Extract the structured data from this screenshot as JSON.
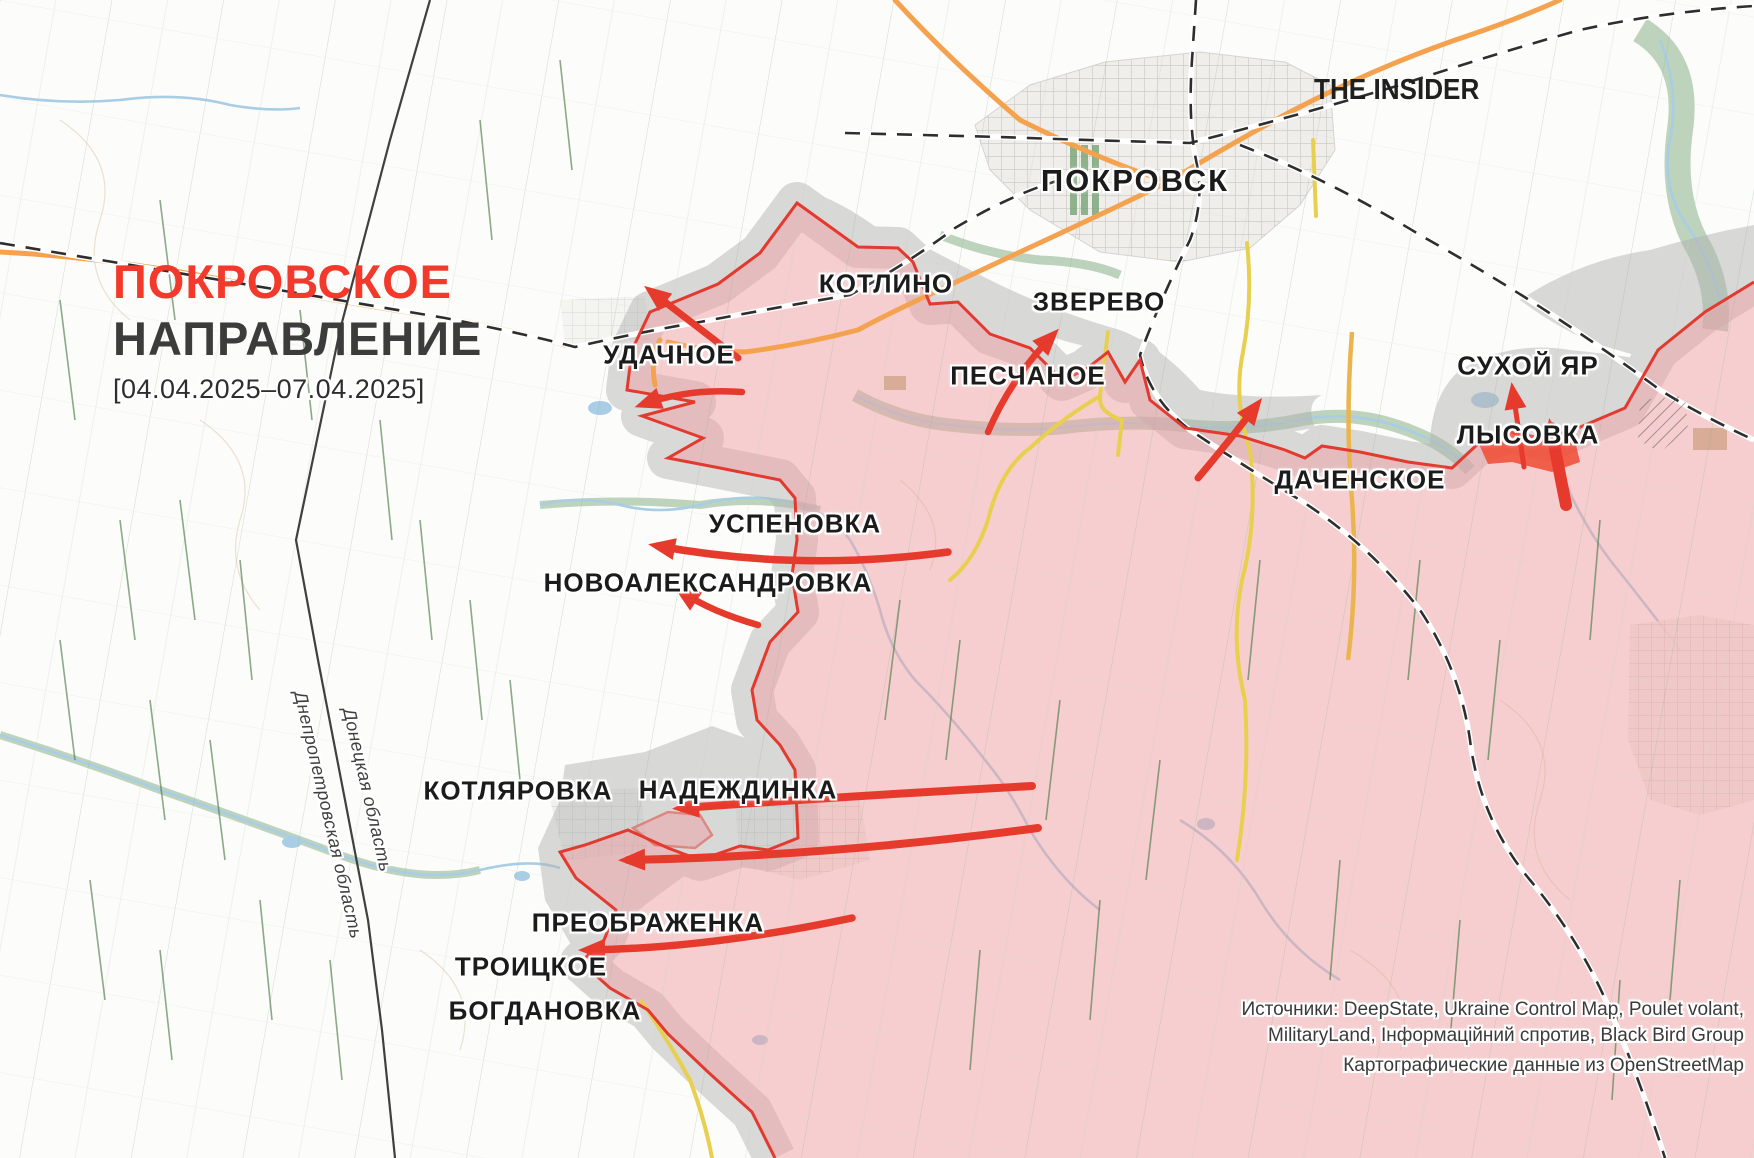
{
  "title": {
    "line1": "ПОКРОВСКОЕ",
    "line2": "НАПРАВЛЕНИЕ",
    "date_range": "[04.04.2025–07.04.2025]"
  },
  "branding": {
    "logo": "THE INSIDER"
  },
  "cities": {
    "pokrovsk": "ПОКРОВСК",
    "kotlino": "КОТЛИНО",
    "zverevo": "ЗВЕРЕВО",
    "udachnoe": "УДАЧНОЕ",
    "peschanoe": "ПЕСЧАНОЕ",
    "sukhoy_yar": "СУХОЙ ЯР",
    "lysovka": "ЛЫСОВКА",
    "dachenskoe": "ДАЧЕНСКОЕ",
    "uspenovka": "УСПЕНОВКА",
    "novoaleksandrovka": "НОВОАЛЕКСАНДРОВКА",
    "kotlyarovka": "КОТЛЯРОВКА",
    "nadezhdinka": "НАДЕЖДИНКА",
    "preobrazhenka": "ПРЕОБРАЖЕНКА",
    "troitskoe": "ТРОИЦКОЕ",
    "bogdanovka": "БОГДАНОВКА"
  },
  "regions": {
    "donetsk": "Донецкая область",
    "dnipropetrovsk": "Днепропетровская область"
  },
  "attribution": {
    "line1": "Источники: DeepState, Ukraine Control Map, Poulet volant,",
    "line2": "MilitaryLand, Інформаційний спротив, Black Bird Group",
    "line3": "Картографические данные из OpenStreetMap"
  },
  "colors": {
    "title_red": "#f2392b",
    "controlled_area_fill": "#f7cfd2",
    "front_line": "#e3392e",
    "contested_area": "#cecece",
    "recent_advance": "#f04a33",
    "attack_arrow": "#e63a2c",
    "road_major": "#f5a24f",
    "road_minor": "#e9cf4f",
    "railway": "#2e2e2e",
    "river": "#a9cde4",
    "field_line": "#6f9a6f"
  }
}
